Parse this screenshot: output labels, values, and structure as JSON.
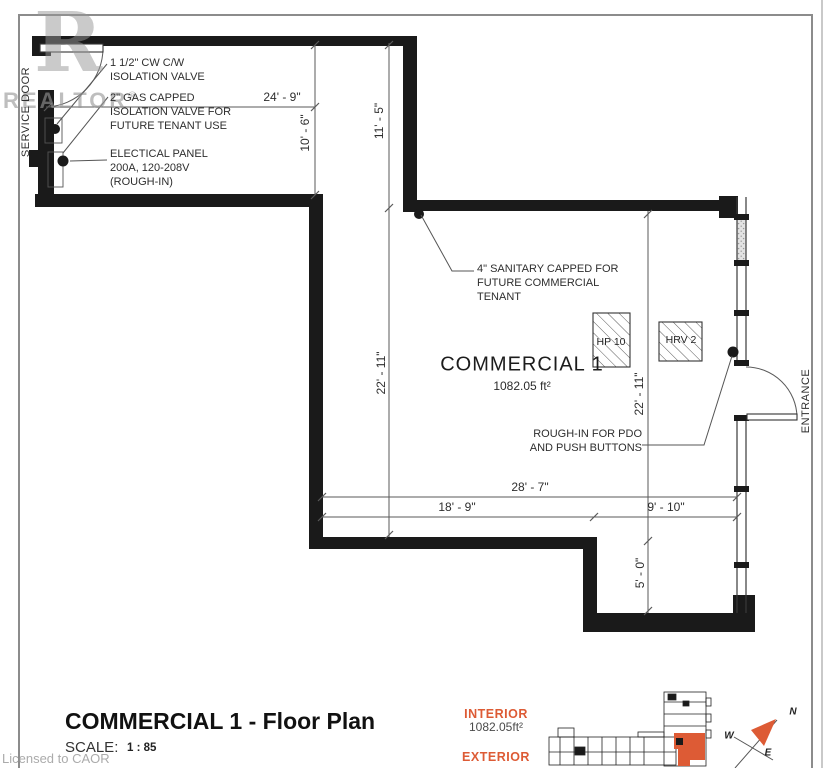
{
  "colors": {
    "accent": "#DD5B35",
    "wall": "#1A1A1A",
    "line": "#4D4D4D",
    "watermark": "#969696",
    "border": "#8C8C8C"
  },
  "watermarks": {
    "logo_letter": "R",
    "realtor": "REALTOR",
    "registered": "®",
    "licensed": "Licensed to CAOR"
  },
  "plan": {
    "labels": {
      "service_door": "SERVICE DOOR",
      "entrance": "ENTRANCE",
      "room_name": "COMMERCIAL 1",
      "room_area": "1082.05 ft²"
    },
    "equipment": {
      "hp": "HP 10",
      "hrv": "HRV 2"
    },
    "annotations": {
      "cw": {
        "l1": "1 1/2\" CW C/W",
        "l2": "ISOLATION VALVE"
      },
      "gas": {
        "l1": "2\" GAS CAPPED",
        "l2": "ISOLATION VALVE FOR",
        "l3": "FUTURE TENANT USE"
      },
      "panel": {
        "l1": "ELECTICAL PANEL",
        "l2": "200A, 120-208V",
        "l3": "(ROUGH-IN)"
      },
      "sanitary": {
        "l1": "4\" SANITARY CAPPED FOR",
        "l2": "FUTURE COMMERCIAL",
        "l3": "TENANT"
      },
      "pdo": {
        "l1": "ROUGH-IN FOR PDO",
        "l2": "AND PUSH BUTTONS"
      }
    },
    "dimensions": {
      "top_width": "24' - 9\"",
      "upper_left_height": "10' - 6\"",
      "upper_right_height": "11' - 5\"",
      "room_height_left": "22' - 11\"",
      "room_height_right": "22' - 11\"",
      "bottom_total": "28' - 7\"",
      "bottom_left": "18' - 9\"",
      "bottom_right": "9' - 10\"",
      "step_height": "5' - 0\""
    }
  },
  "footer": {
    "title": "COMMERCIAL 1 - Floor Plan",
    "scale_label": "SCALE:",
    "scale_value": "1 : 85"
  },
  "legend": {
    "interior_label": "INTERIOR",
    "interior_value": "1082.05ft²",
    "exterior_label": "EXTERIOR"
  },
  "compass": {
    "n": "N",
    "w": "W",
    "e": "E"
  }
}
